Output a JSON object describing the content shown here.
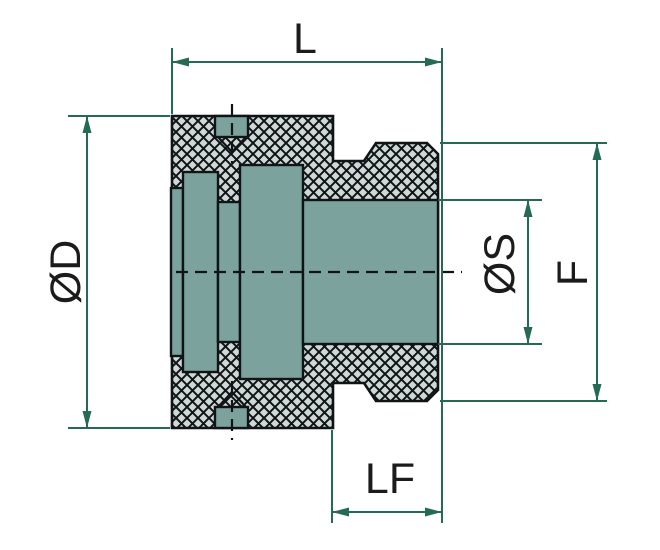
{
  "drawing": {
    "title": "Coupling cross-section dimension drawing",
    "dimensions": {
      "L": {
        "label": "L"
      },
      "OD": {
        "label": "ØD"
      },
      "OS": {
        "label": "ØS"
      },
      "F": {
        "label": "F"
      },
      "LF": {
        "label": "LF"
      }
    }
  },
  "colors": {
    "bg": "#ffffff",
    "line": "#101417",
    "part_fill": "#7ba29c",
    "hatch_fill": "#cfd8d5",
    "dim": "#256a54",
    "label": "#1b1b1b"
  }
}
